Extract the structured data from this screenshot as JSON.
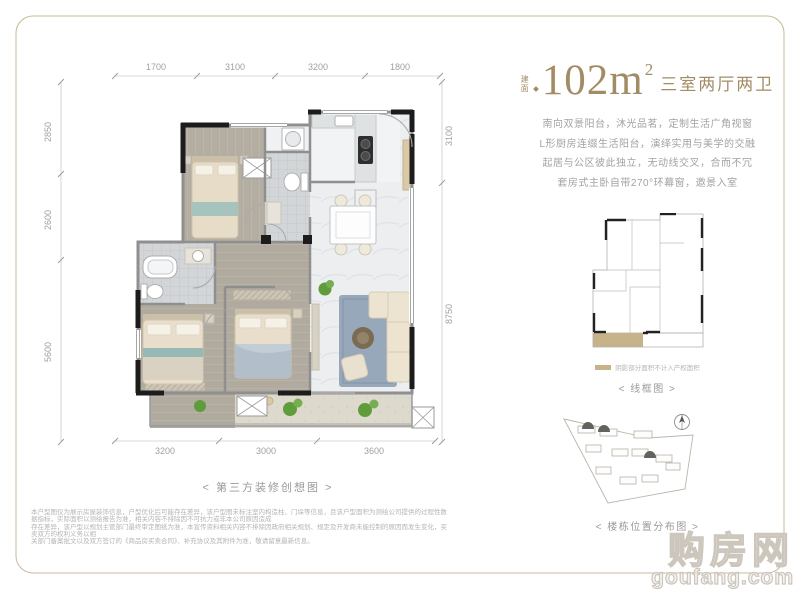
{
  "title": {
    "area_prefix": "建面",
    "area_value": "102m",
    "area_sup": "2",
    "rooms": "三室两厅两卫"
  },
  "description": {
    "lines": [
      "南向双景阳台，沐光品茗，定制生活广角视窗",
      "L形厨房连缀生活阳台，演绎实用与美学的交融",
      "起居与公区彼此独立，无动线交叉，合而不冗",
      "套房式主卧自带270°环幕窗，邀景入室"
    ]
  },
  "floor_plan": {
    "dims_top": [
      "1700",
      "3100",
      "3200",
      "1800"
    ],
    "dims_left": [
      "2850",
      "2600",
      "5600"
    ],
    "dims_right": [
      "3100",
      "8750"
    ],
    "dims_bottom": [
      "3200",
      "3000",
      "3600"
    ],
    "caption": "< 第三方装修创想图 >"
  },
  "wireframe": {
    "legend_text": "阴影部分面积不计入产权面积",
    "caption": "< 线框图 >"
  },
  "site_plan": {
    "caption": "< 楼栋位置分布图 >"
  },
  "disclaimer": {
    "lines": [
      "本户型图仅为展示房屋装饰信息，户型优化后可能存在差异，该户型图未标注室内构造柱、门垛等信息，且该户型面积为测绘公司提供的过程性数据指标，实际面积以测绘报告为准，相关内容不排除因不可抗力或非本公司原因造成",
      "存在差异，该户型以规划主管部门最终审定图纸为准，本宣传资料相关内容不排除因政府相关规划、规定及开发商未能控制的原因而发生变化，买卖双方的权利义务以相",
      "关部门备案批文以及双方签订的《商品房买卖合同》、补充协议及其附件为准，敬请留意最新信息。"
    ]
  },
  "watermark": {
    "name": "购房网",
    "domain": "goufang.com"
  },
  "colors": {
    "accent_bronze": "#a38c65",
    "frame_gold": "#c9b99b",
    "wall_black": "#1c1c1c",
    "wall_gray": "#8f8f8f",
    "wood_floor": "#b3ada2",
    "marble_floor": "#eceef0",
    "tile_floor": "#d3d6d8",
    "rug_blue": "#8da0b3",
    "plant_green": "#5f9c3c",
    "shaded_area_tan": "#c8b28a"
  }
}
